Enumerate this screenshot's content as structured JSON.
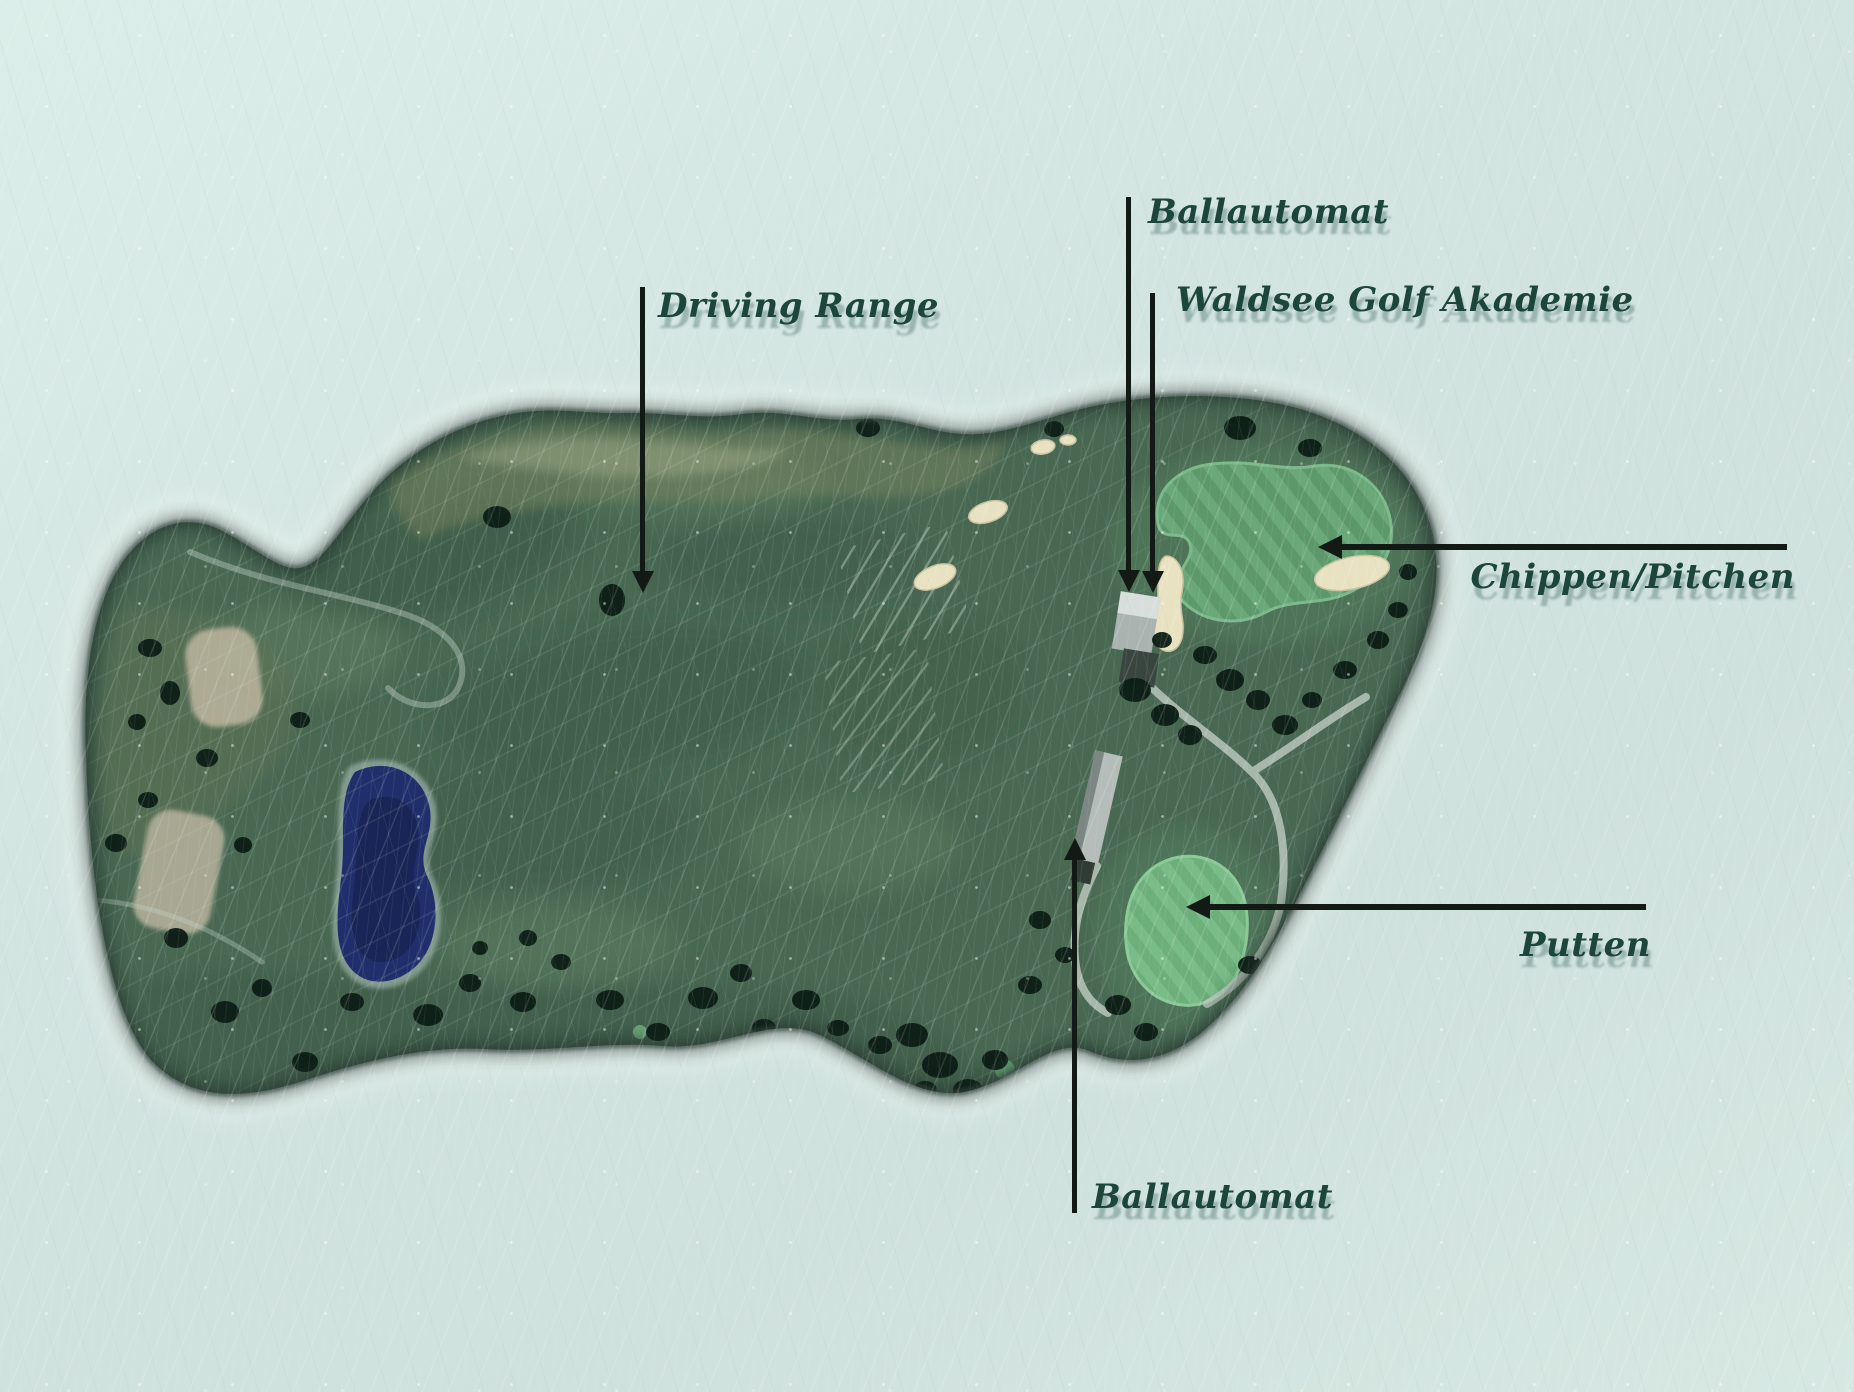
{
  "labels": {
    "ballautomat_top": "Ballautomat",
    "waldsee_akademie": "Waldsee Golf Akademie",
    "driving_range": "Driving Range",
    "chippen_pitchen": "Chippen/Pitchen",
    "putten": "Putten",
    "ballautomat_bottom": "Ballautomat"
  },
  "colors": {
    "background_mint": "#d2e4e0",
    "label_text": "#1d463a",
    "label_shadow": "rgba(98,133,127,0.5)",
    "arrow_black": "#131915",
    "course_base_green": "#486852",
    "practice_green_bright": "#6fb07e",
    "pond_navy": "#202f6b",
    "bare_ground_beige": "#b7b29b",
    "bunker_cream": "#e9e2c2",
    "building_roof_gray": "#b4bdb9"
  },
  "map_features": [
    "driving-range-field",
    "rough-top-band",
    "left-scrub-area",
    "bare-patch",
    "pond",
    "range-target-grid",
    "chipping-green",
    "putting-green",
    "bunker",
    "academy-building",
    "ball-machine-shed",
    "cart-path",
    "trees"
  ]
}
